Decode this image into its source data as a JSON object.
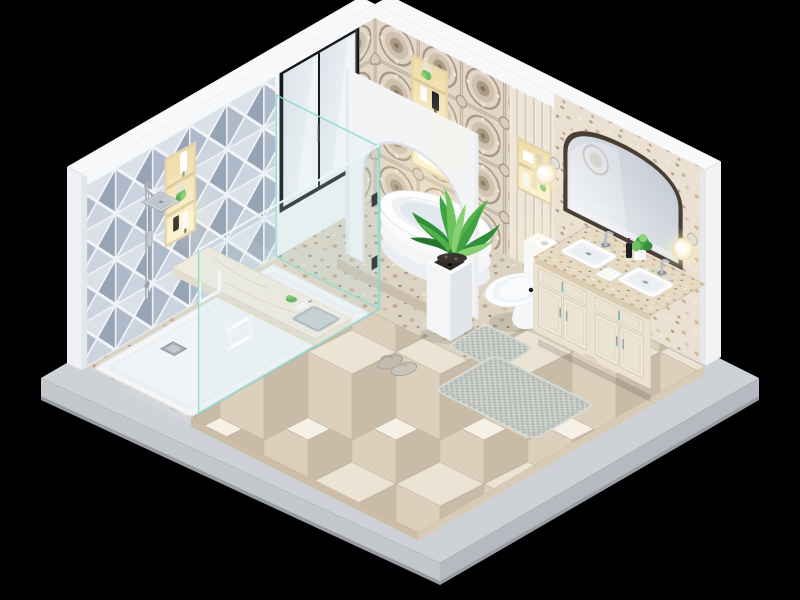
{
  "scene": {
    "type": "isometric-3d-render",
    "subject": "bathroom-interior-cutaway",
    "view": "dollhouse isometric, two walls removed, floating on black background",
    "background_color": "#000000"
  },
  "palette": {
    "background": "#000000",
    "base_slab_top": "#ced2d7",
    "base_slab_side_right": "#b6bac0",
    "base_slab_side_left": "#c4c8cd",
    "white_wall": "#f3f5f7",
    "diamond_tile_base": "#c9d1dc",
    "diamond_tile_light": "#dbe1e9",
    "diamond_tile_dark": "#97a4b6",
    "wallpaper_base": "#e1d7c9",
    "wallpaper_accent": "#a7947f",
    "slat_panel": "#eee7d9",
    "terrazzo_wall": "#ebe1d3",
    "terrazzo_floor": "#ddd3c2",
    "floor_cube_top": "#f6f1e7",
    "floor_cube_left": "#dcd0bd",
    "floor_cube_right": "#c8bba7",
    "shower_tray": "#f3f5f7",
    "glass_edge_teal": "#8adbcf",
    "fixture_white": "#fdfdfe",
    "vanity_cream": "#ebe2d1",
    "counter_granite": "#e7dac2",
    "mirror_frame_bronze": "#4a3e33",
    "chrome": "#b6bdc5",
    "niche_glow_warm": "#f8e9c3",
    "plant_green": "#3fa344",
    "mat_gray": "#c8ccc7",
    "window_frame_black": "#17181b"
  },
  "objects": {
    "structure": [
      {
        "name": "base-slab",
        "label": "concrete base platform"
      },
      {
        "name": "left-wall",
        "label": "wall with 3D diamond pattern tiles"
      },
      {
        "name": "back-wall",
        "label": "wall with ornate wallpaper, slat panel and terrazzo"
      },
      {
        "name": "arch-partition",
        "label": "white arched partition enclosing bathtub nook"
      },
      {
        "name": "window",
        "label": "black framed window above tub nook"
      }
    ],
    "fixtures": [
      {
        "name": "shower-area",
        "label": "walk-in shower with glass panels, rain head, wall niche"
      },
      {
        "name": "bathtub",
        "label": "white freestanding tub on terrazzo platform"
      },
      {
        "name": "toilet",
        "label": "white one-piece toilet"
      },
      {
        "name": "vanity",
        "label": "double-sink vanity with cream cabinets and granite top"
      },
      {
        "name": "mirror",
        "label": "arched bronze-framed mirror"
      },
      {
        "name": "sconces",
        "label": "two glowing globe wall lamps"
      }
    ],
    "accessories": [
      {
        "name": "shower-bench",
        "label": "floating marble bench with towel and toiletries"
      },
      {
        "name": "wall-niches",
        "label": "three recessed lit niches with bottles, towels, succulents"
      },
      {
        "name": "potted-plant",
        "label": "tall white planter with green plant"
      },
      {
        "name": "bath-mats",
        "label": "gray textured contour mat and runner mat"
      },
      {
        "name": "slippers",
        "label": "pair of gray slippers"
      },
      {
        "name": "counter-items",
        "label": "waffle towel, plant, black soap dispenser, faucets"
      }
    ]
  }
}
